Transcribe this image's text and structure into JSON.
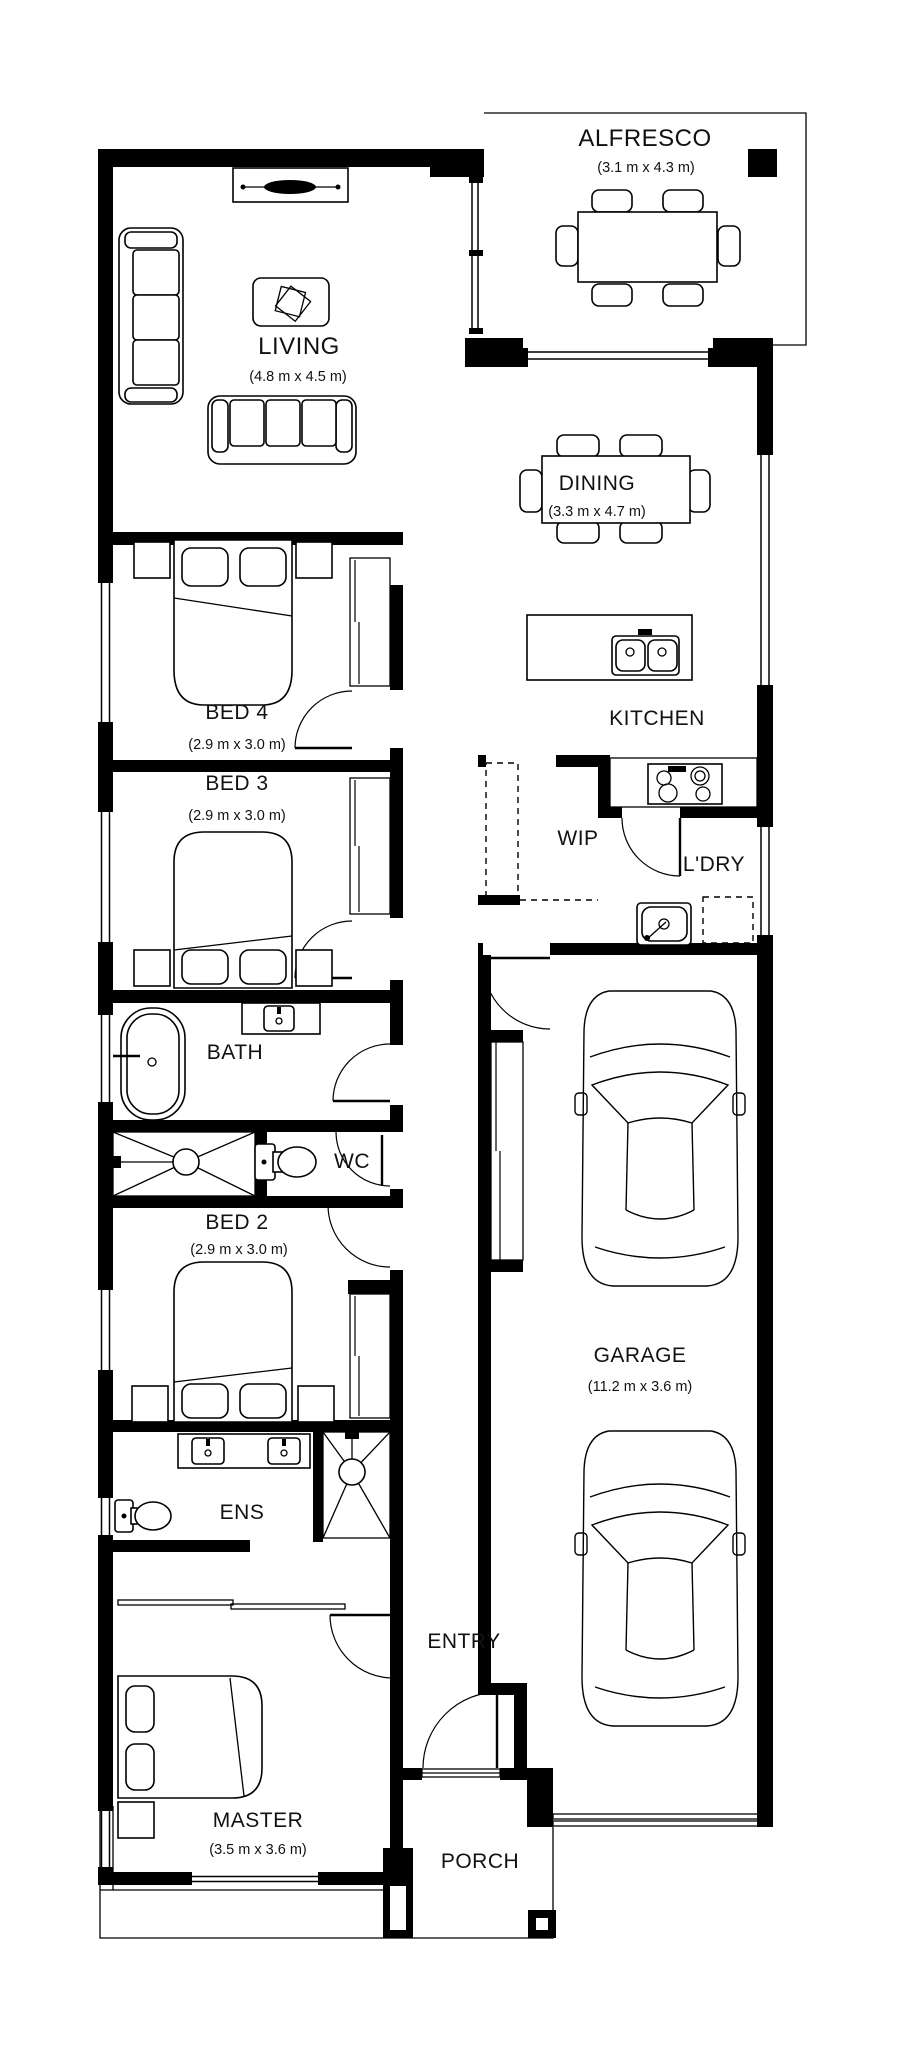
{
  "plan": {
    "colors": {
      "wall": "#000000",
      "paper": "#ffffff",
      "linework": "#000000"
    },
    "rooms": {
      "alfresco": {
        "label": "ALFRESCO",
        "dims": "(3.1 m x 4.3 m)"
      },
      "living": {
        "label": "LIVING",
        "dims": "(4.8 m x 4.5 m)"
      },
      "dining": {
        "label": "DINING",
        "dims": "(3.3 m x 4.7 m)"
      },
      "kitchen": {
        "label": "KITCHEN"
      },
      "wip": {
        "label": "WIP"
      },
      "ldry": {
        "label": "L'DRY"
      },
      "bed4": {
        "label": "BED 4",
        "dims": "(2.9 m x 3.0 m)"
      },
      "bed3": {
        "label": "BED 3",
        "dims": "(2.9 m x 3.0 m)"
      },
      "bath": {
        "label": "BATH"
      },
      "wc": {
        "label": "WC"
      },
      "bed2": {
        "label": "BED 2",
        "dims": "(2.9 m x 3.0 m)"
      },
      "ens": {
        "label": "ENS"
      },
      "garage": {
        "label": "GARAGE",
        "dims": "(11.2 m x 3.6 m)"
      },
      "master": {
        "label": "MASTER",
        "dims": "(3.5 m x 3.6 m)"
      },
      "entry": {
        "label": "ENTRY"
      },
      "porch": {
        "label": "PORCH"
      }
    }
  }
}
